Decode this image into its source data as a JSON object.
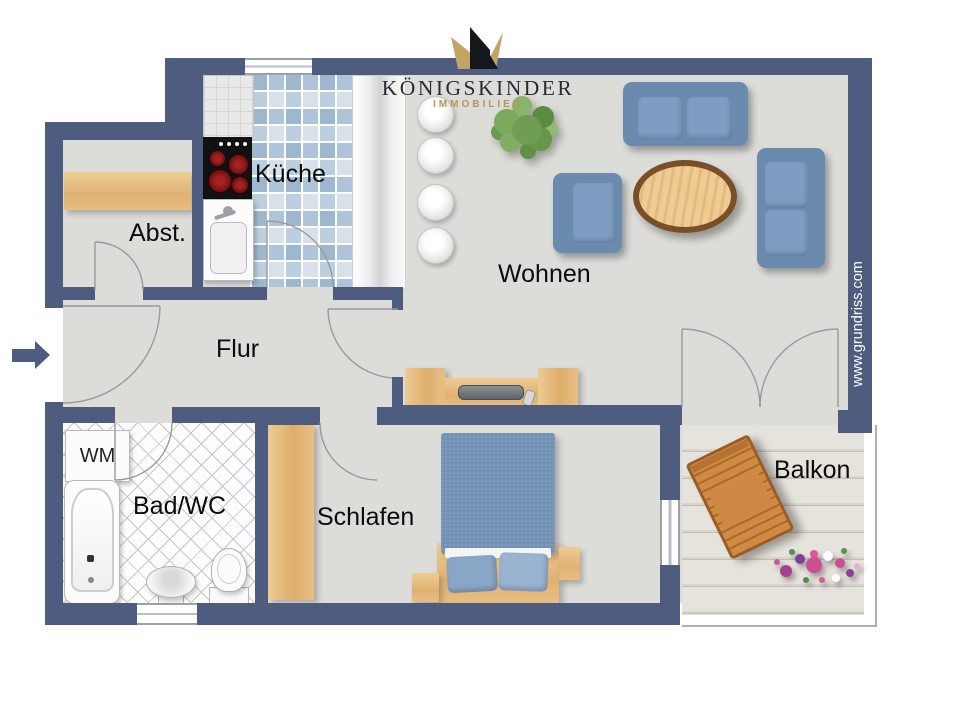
{
  "brand": {
    "name": "KÖNIGSKINDER",
    "tagline": "IMMOBILIEN"
  },
  "watermark": "www.grundriss.com",
  "rooms": {
    "kueche": {
      "label": "Küche"
    },
    "abst": {
      "label": "Abst."
    },
    "flur": {
      "label": "Flur"
    },
    "wohnen": {
      "label": "Wohnen"
    },
    "bad": {
      "label": "Bad/WC"
    },
    "schlafen": {
      "label": "Schlafen"
    },
    "balkon": {
      "label": "Balkon"
    }
  },
  "appliances": {
    "washing_machine": "WM"
  },
  "colors": {
    "wall": "#4e5c7f",
    "floor": "#dcdcd8",
    "kitchen_tile": "#aec4d8",
    "sofa_blue": "#6a8aae",
    "wood": "#e3b97e",
    "logo_gold": "#c3a368",
    "logo_text": "#272c38",
    "tagline_gold": "#b3985e"
  }
}
